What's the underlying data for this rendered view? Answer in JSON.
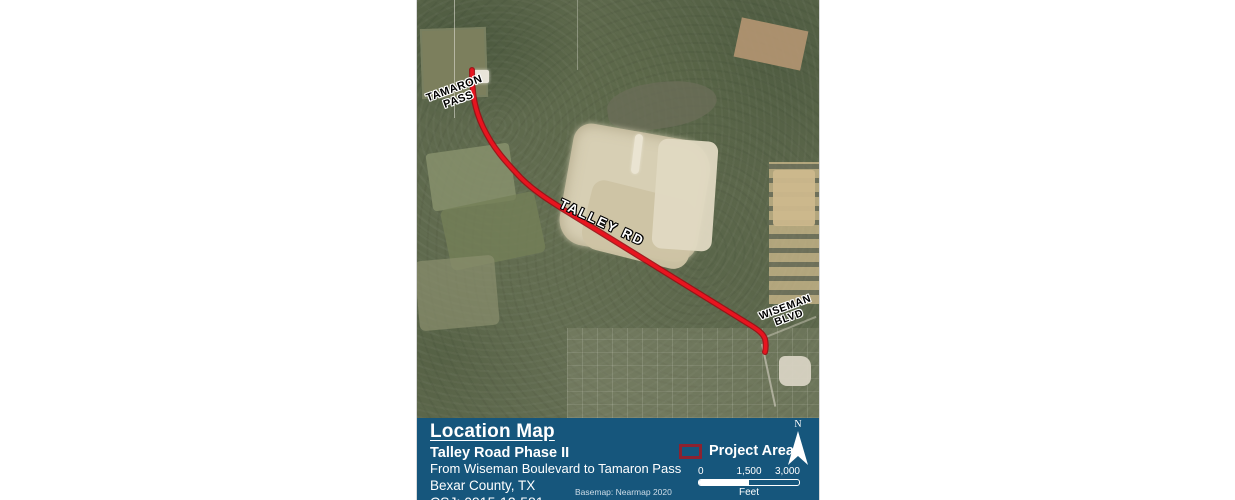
{
  "map": {
    "labels": {
      "tamaron_line1": "TAMARON",
      "tamaron_line2": "PASS",
      "talley": "TALLEY RD",
      "wiseman_line1": "WISEMAN",
      "wiseman_line2": "BLVD"
    }
  },
  "title_block": {
    "title": "Location Map",
    "subtitle": "Talley Road Phase II",
    "description": "From Wiseman Boulevard to Tamaron Pass",
    "county": "Bexar County, TX",
    "csj": "CSJ: 0915-12-581",
    "basemap_credit": "Basemap: Nearmap 2020"
  },
  "legend": {
    "project_area": "Project Area"
  },
  "north_arrow": {
    "label": "N"
  },
  "scale_bar": {
    "tick_0": "0",
    "tick_mid": "1,500",
    "tick_max": "3,000",
    "unit": "Feet"
  },
  "colors": {
    "panel_bg": "#16567C",
    "route_red": "#E8141F",
    "route_casing": "#9C0D14",
    "legend_outline": "#8C2230"
  }
}
